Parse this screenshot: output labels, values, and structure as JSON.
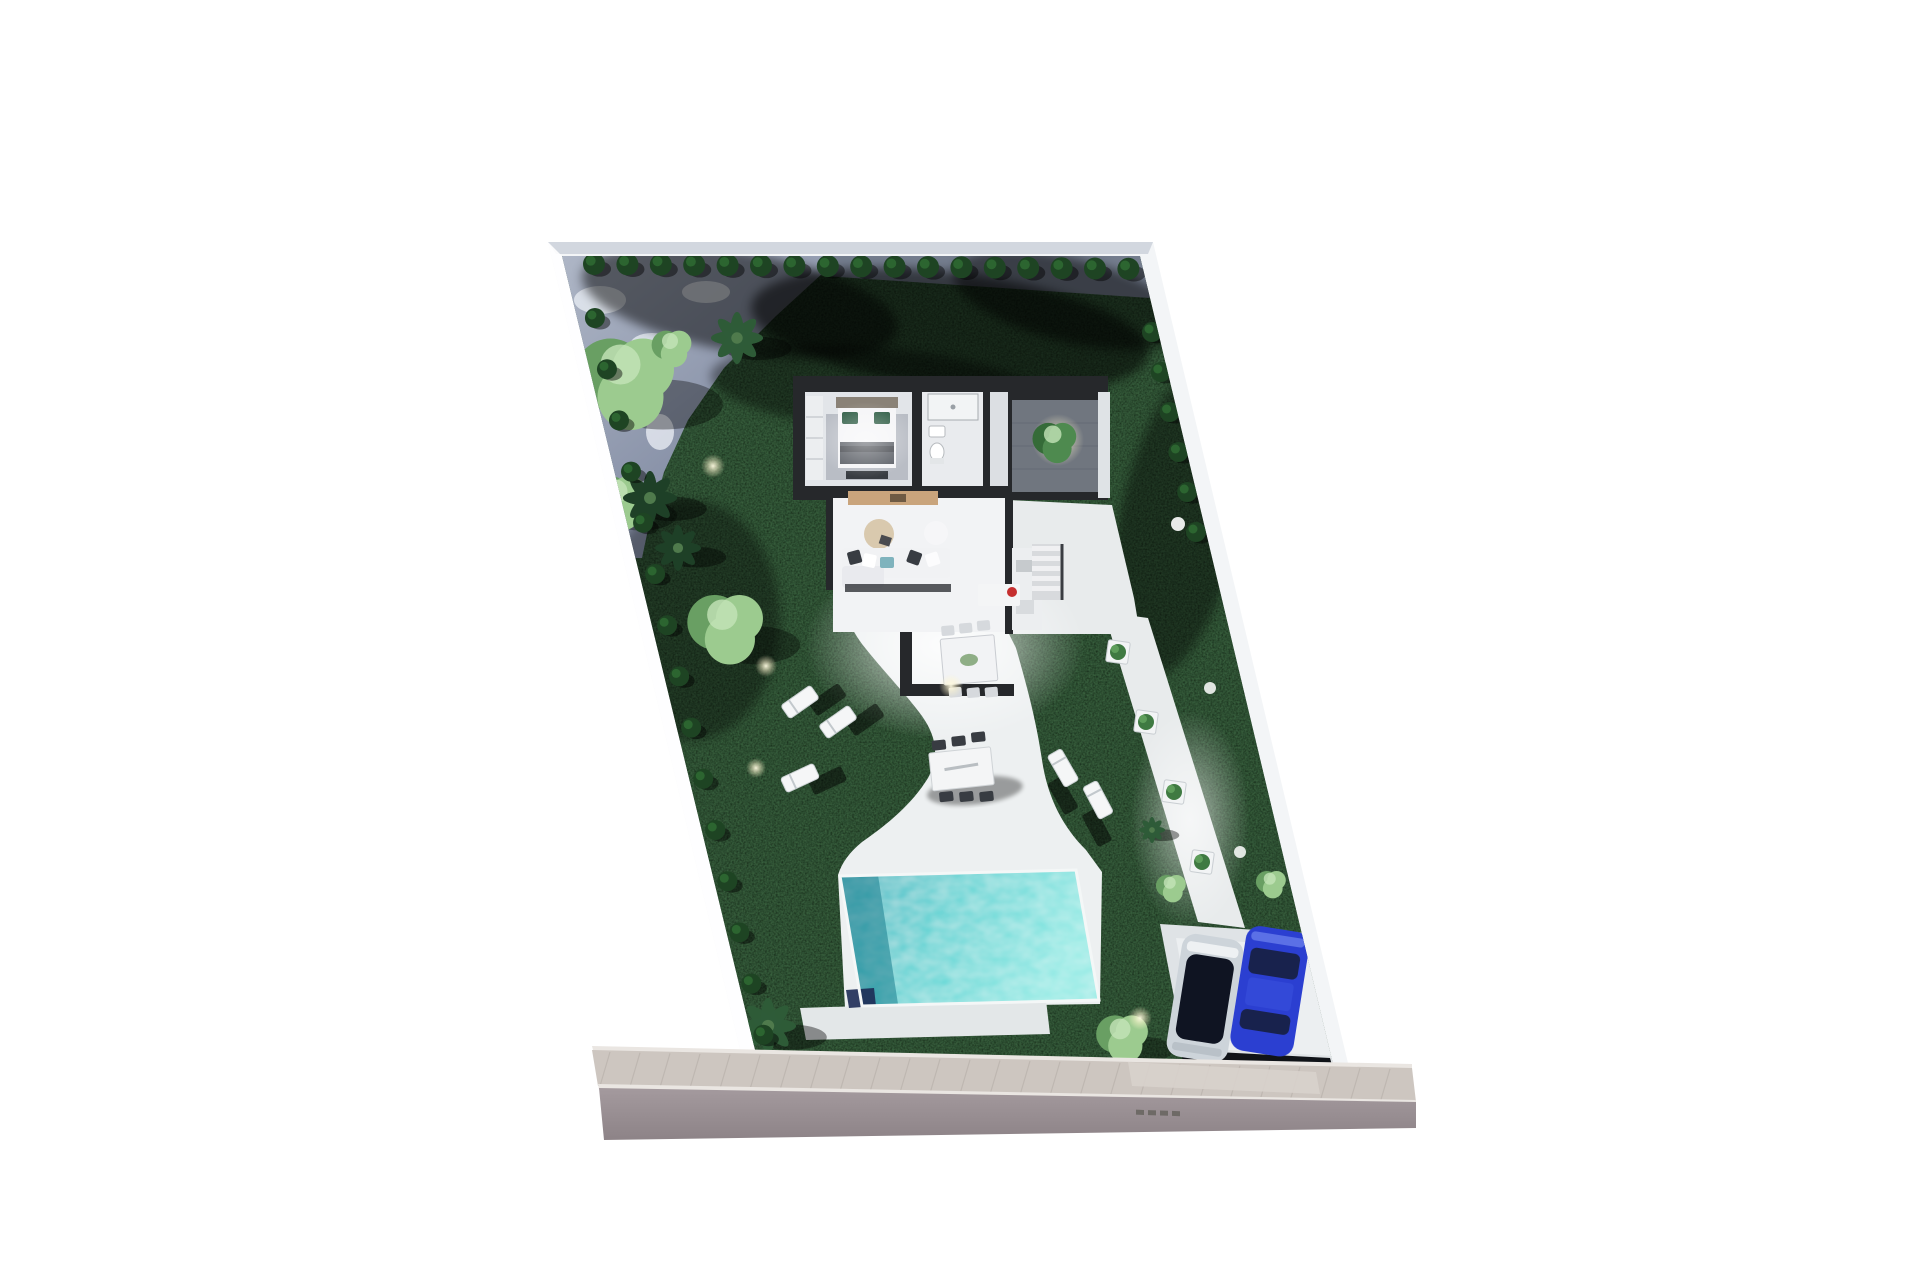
{
  "scene": {
    "type": "3d-aerial-site-plan-render",
    "subject": "single villa plot with garden, pool and carport"
  },
  "palette": {
    "page_bg": "#ffffff",
    "plot_wall": "#f3f5f7",
    "wall_shade": "#c9cfd8",
    "grass": "#0d1b0f",
    "grass_light": "#1e3a20",
    "paved": "#98a1b2",
    "paved_shadow": "#6b7386",
    "hedge": "#1e4423",
    "hedge_dark": "#122c18",
    "tree_light": "#9ccb8f",
    "tree_light_dark": "#699f63",
    "palm": "#2e5c38",
    "palm_dark": "#1f4027",
    "terrace": "#edf0f1",
    "path": "#e8ebec",
    "house_wall": "#26282b",
    "floor": "#e2e5e9",
    "floor_bright": "#f2f3f5",
    "rug": "#b9bdc5",
    "wood": "#c9a47c",
    "sofa": "#f1f2f4",
    "teal": "#7fb3bd",
    "charcoal": "#383c42",
    "green_pillow": "#2f5d45",
    "courtyard": "#70767f",
    "pool_light": "#7fe3df",
    "pool_dark": "#2fb3be",
    "pool_navy": "#1d2b55",
    "deck": "#e3e7e8",
    "car_silver": "#cdd4da",
    "car_glass": "#0f1422",
    "car_blue": "#2b3fd1",
    "car_blue_dark": "#18224d",
    "sidewalk": "#cdc6c0",
    "road": "#9b9196",
    "curb": "#eae6e2",
    "apron": "#d8d2cc",
    "glow": "#fff6cf",
    "red": "#c62f2f",
    "white": "#ffffff"
  }
}
